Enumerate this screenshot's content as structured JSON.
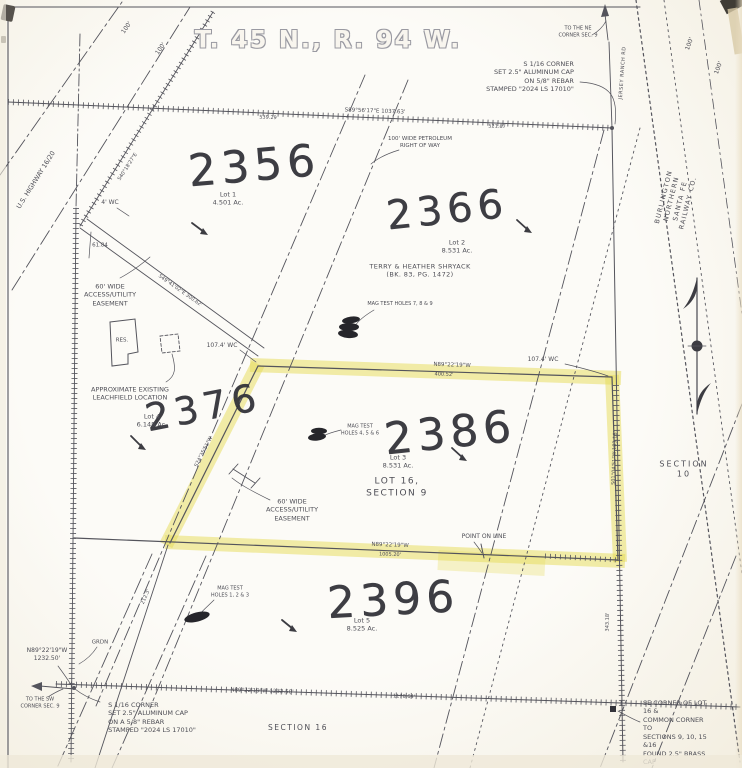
{
  "title": "T. 45 N., R. 94 W.",
  "colors": {
    "highlighter": "#e6dc55",
    "ink": "#54545c",
    "handwriting": "#33333a",
    "paper": "#f9f6ee"
  },
  "parcels": [
    {
      "number": "2356",
      "lot": "Lot 1",
      "acreage": "4.501 Ac."
    },
    {
      "number": "2366",
      "lot": "Lot 2",
      "acreage": "8.531 Ac.",
      "owner": "TERRY & HEATHER SHRYACK",
      "deed": "(BK. 83, PG. 1472)"
    },
    {
      "number": "2376",
      "lot": "Lot 4",
      "acreage": "6.148 Ac."
    },
    {
      "number": "2386",
      "lot": "Lot 3",
      "acreage": "8.531 Ac.",
      "tract": "LOT 16, SECTION 9",
      "highlighted": true
    },
    {
      "number": "2396",
      "lot": "Lot 5",
      "acreage": "8.525 Ac."
    }
  ],
  "map_labels": [
    {
      "id": "hw-2356",
      "t": "2356",
      "x": 254,
      "y": 166,
      "fs": 44,
      "rot": -5,
      "cls": "hw"
    },
    {
      "id": "hw-2366",
      "t": "2366",
      "x": 447,
      "y": 210,
      "fs": 40,
      "rot": -6,
      "cls": "hw"
    },
    {
      "id": "hw-2376",
      "t": "2376",
      "x": 203,
      "y": 408,
      "fs": 38,
      "rot": -11,
      "cls": "hw"
    },
    {
      "id": "hw-2386",
      "t": "2386",
      "x": 450,
      "y": 433,
      "fs": 44,
      "rot": -6,
      "cls": "hw"
    },
    {
      "id": "hw-2396",
      "t": "2396",
      "x": 393,
      "y": 600,
      "fs": 44,
      "rot": -3,
      "cls": "hw"
    },
    {
      "id": "lot1-label",
      "t": "Lot 1\n4.501 Ac.",
      "x": 228,
      "y": 199,
      "fs": 6.5
    },
    {
      "id": "lot2-label",
      "t": "Lot 2\n8.531 Ac.",
      "x": 457,
      "y": 247,
      "fs": 6.5
    },
    {
      "id": "owner-label",
      "t": "TERRY & HEATHER SHRYACK\n(BK. 83, PG. 1472)",
      "x": 420,
      "y": 271,
      "fs": 6.5,
      "ls": 0.4
    },
    {
      "id": "lot3-label",
      "t": "Lot 3\n8.531 Ac.",
      "x": 398,
      "y": 462,
      "fs": 6.5
    },
    {
      "id": "lot16-label",
      "t": "LOT 16,\nSECTION 9",
      "x": 397,
      "y": 488,
      "fs": 9,
      "ls": 1.5
    },
    {
      "id": "lot4-label",
      "t": "Lot 4\n6.148 Ac.",
      "x": 152,
      "y": 421,
      "fs": 6.5
    },
    {
      "id": "lot5-label",
      "t": "Lot 5\n8.525 Ac.",
      "x": 362,
      "y": 625,
      "fs": 6.5
    },
    {
      "id": "section-10-label",
      "t": "SECTION 10",
      "x": 684,
      "y": 470,
      "fs": 8,
      "ls": 2
    },
    {
      "id": "section-16-label",
      "t": "SECTION 16",
      "x": 298,
      "y": 728,
      "fs": 7.5,
      "ls": 1.5
    },
    {
      "id": "easement-label-1",
      "t": "60' WIDE\nACCESS/UTILITY\nEASEMENT",
      "x": 110,
      "y": 295,
      "fs": 6.5
    },
    {
      "id": "easement-label-2",
      "t": "60' WIDE\nACCESS/UTILITY\nEASEMENT",
      "x": 292,
      "y": 510,
      "fs": 6.5
    },
    {
      "id": "leachfield-label",
      "t": "APPROXIMATE EXISTING\nLEACHFIELD LOCATION",
      "x": 130,
      "y": 394,
      "fs": 6.5
    },
    {
      "id": "res-label",
      "t": "RES.",
      "x": 122,
      "y": 341,
      "fs": 5.5
    },
    {
      "id": "wc-4-label",
      "t": "4' WC",
      "x": 110,
      "y": 203,
      "fs": 6
    },
    {
      "id": "dim-61-84",
      "t": "61.84",
      "x": 100,
      "y": 246,
      "fs": 5.5
    },
    {
      "id": "wc-107-west",
      "t": "107.4' WC",
      "x": 222,
      "y": 346,
      "fs": 6
    },
    {
      "id": "wc-107-east",
      "t": "107.4' WC",
      "x": 543,
      "y": 360,
      "fs": 6
    },
    {
      "id": "mag-test-789",
      "t": "MAG TEST HOLES 7, 8 & 9",
      "x": 400,
      "y": 304,
      "fs": 5
    },
    {
      "id": "mag-test-456",
      "t": "MAG TEST\nHOLES 4, 5 & 6",
      "x": 360,
      "y": 430,
      "fs": 5
    },
    {
      "id": "mag-test-123",
      "t": "MAG TEST\nHOLES 1, 2 & 3",
      "x": 230,
      "y": 592,
      "fs": 5
    },
    {
      "id": "ne-corner-note",
      "t": "S 1/16 CORNER\nSET 2.5\" ALUMINUM CAP\nON 5/8\" REBAR\nSTAMPED \"2024 LS 17010\"",
      "x": 530,
      "y": 77,
      "fs": 6.5,
      "align": "right"
    },
    {
      "id": "to-ne-corner",
      "t": "TO THE NE\nCORNER SEC. 9",
      "x": 578,
      "y": 32,
      "fs": 5
    },
    {
      "id": "petroleum-row-label",
      "t": "100' WIDE PETROLEUM\nRIGHT OF WAY",
      "x": 420,
      "y": 143,
      "fs": 5.5
    },
    {
      "id": "us-highway-label",
      "t": "U.S. HIGHWAY 16/20",
      "x": 36,
      "y": 180,
      "fs": 6.5,
      "rot": -58
    },
    {
      "id": "hwy-100-a",
      "t": "100'",
      "x": 127,
      "y": 28,
      "fs": 6,
      "rot": -55
    },
    {
      "id": "hwy-100-b",
      "t": "100'",
      "x": 161,
      "y": 49,
      "fs": 6,
      "rot": -55
    },
    {
      "id": "rr-100-a",
      "t": "100'",
      "x": 690,
      "y": 44,
      "fs": 6,
      "rot": -70
    },
    {
      "id": "rr-100-b",
      "t": "100'",
      "x": 719,
      "y": 68,
      "fs": 6,
      "rot": -70
    },
    {
      "id": "bnsf-label",
      "t": "BURLINGTON NORTHERN SANTA FE RAILWAY CO.",
      "x": 676,
      "y": 200,
      "fs": 6.5,
      "rot": -76,
      "ls": 1.2
    },
    {
      "id": "jersey-ranch-rd-label",
      "t": "JERSEY RANCH RD",
      "x": 623,
      "y": 73,
      "fs": 5,
      "rot": -86,
      "ls": 0.5
    },
    {
      "id": "top-line-bearing",
      "t": "S89°56'17\"E  1037.63'",
      "x": 375,
      "y": 112,
      "fs": 5.5,
      "rot": 2
    },
    {
      "id": "dim-539-29",
      "t": "539.29",
      "x": 268,
      "y": 118,
      "fs": 5,
      "rot": 2
    },
    {
      "id": "dim-521-87",
      "t": "521.87",
      "x": 497,
      "y": 127,
      "fs": 5,
      "rot": 2
    },
    {
      "id": "north-bdy-bearing",
      "t": "N89°22'19\"W",
      "x": 452,
      "y": 366,
      "fs": 5.5,
      "rot": 2
    },
    {
      "id": "north-bdy-dist",
      "t": "400.52'",
      "x": 444,
      "y": 375,
      "fs": 5,
      "rot": 2
    },
    {
      "id": "south-bdy-bearing",
      "t": "N89°22'19\"W",
      "x": 390,
      "y": 546,
      "fs": 5.5,
      "rot": 2
    },
    {
      "id": "south-bdy-dist",
      "t": "1005.20'",
      "x": 390,
      "y": 555,
      "fs": 5,
      "rot": 2
    },
    {
      "id": "point-on-line-label",
      "t": "POINT ON LINE",
      "x": 484,
      "y": 537,
      "fs": 6
    },
    {
      "id": "bottom-line-bearing",
      "t": "N89°22'19\"W  1232.50'",
      "x": 262,
      "y": 692,
      "fs": 5.5,
      "rot": 2
    },
    {
      "id": "dim-1178-64",
      "t": "1178.64'",
      "x": 404,
      "y": 697,
      "fs": 5,
      "rot": 2
    },
    {
      "id": "sw-distance-label",
      "t": "N89°22'19\"W\n1232.50'",
      "x": 47,
      "y": 655,
      "fs": 6
    },
    {
      "id": "to-sw-corner",
      "t": "TO THE SW\nCORNER SEC. 9",
      "x": 40,
      "y": 703,
      "fs": 5
    },
    {
      "id": "sw-corner-note",
      "t": "S 1/16 CORNER\nSET 2.5\" ALUMINUM CAP\nON A 5/8\" REBAR\nSTAMPED \"2024 LS 17010\"",
      "x": 152,
      "y": 718,
      "fs": 6.5,
      "align": "left"
    },
    {
      "id": "se-corner-note",
      "t": "SE CORNER OF LOT 16 &\nCOMMON CORNER TO\nSECTIONS 9, 10, 15 &16\nFOUND 2.5\" BRASS CAP\nON A 3\" PIPE",
      "x": 676,
      "y": 737,
      "fs": 6.5,
      "align": "left"
    },
    {
      "id": "grdn-label",
      "t": "GRDN",
      "x": 100,
      "y": 643,
      "fs": 5.5
    },
    {
      "id": "east-line-dist",
      "t": "343.18'",
      "x": 608,
      "y": 622,
      "fs": 5,
      "rot": -89
    },
    {
      "id": "sw-diag-dist",
      "t": "212.3'",
      "x": 146,
      "y": 597,
      "fs": 5,
      "rot": -66
    },
    {
      "id": "road-bearing",
      "t": "S49°41'02\"E  300.62'",
      "x": 180,
      "y": 291,
      "fs": 5,
      "rot": 35
    },
    {
      "id": "fence-bearing",
      "t": "S40°18'27\"E",
      "x": 128,
      "y": 167,
      "fs": 5,
      "rot": -57
    },
    {
      "id": "west-bdy-bearing",
      "t": "S24°35'51\"W",
      "x": 204,
      "y": 452,
      "fs": 5,
      "rot": -63
    },
    {
      "id": "east-bdy-bearing",
      "t": "S01°04'51\"W  183.18'",
      "x": 615,
      "y": 458,
      "fs": 5,
      "rot": -88
    }
  ]
}
